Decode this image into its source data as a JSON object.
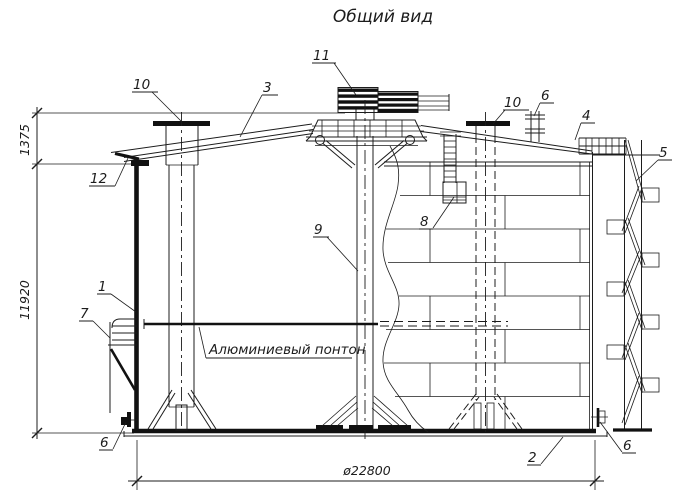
{
  "title": "Общий вид",
  "labels": {
    "pontoon": "Алюминиевый понтон"
  },
  "dimensions": {
    "roof_rise": "1375",
    "shell_height": "11920",
    "diameter": "ø22800"
  },
  "callouts": {
    "pos1": "1",
    "pos2": "2",
    "pos3": "3",
    "pos4": "4",
    "pos5": "5",
    "pos6_roof": "6",
    "pos6_shell_left": "6",
    "pos6_shell_right": "6",
    "pos7": "7",
    "pos8": "8",
    "pos9": "9",
    "pos10_left": "10",
    "pos10_right": "10",
    "pos11": "11",
    "pos12": "12"
  },
  "colors": {
    "line": "#1c1c1c",
    "background": "#ffffff"
  }
}
